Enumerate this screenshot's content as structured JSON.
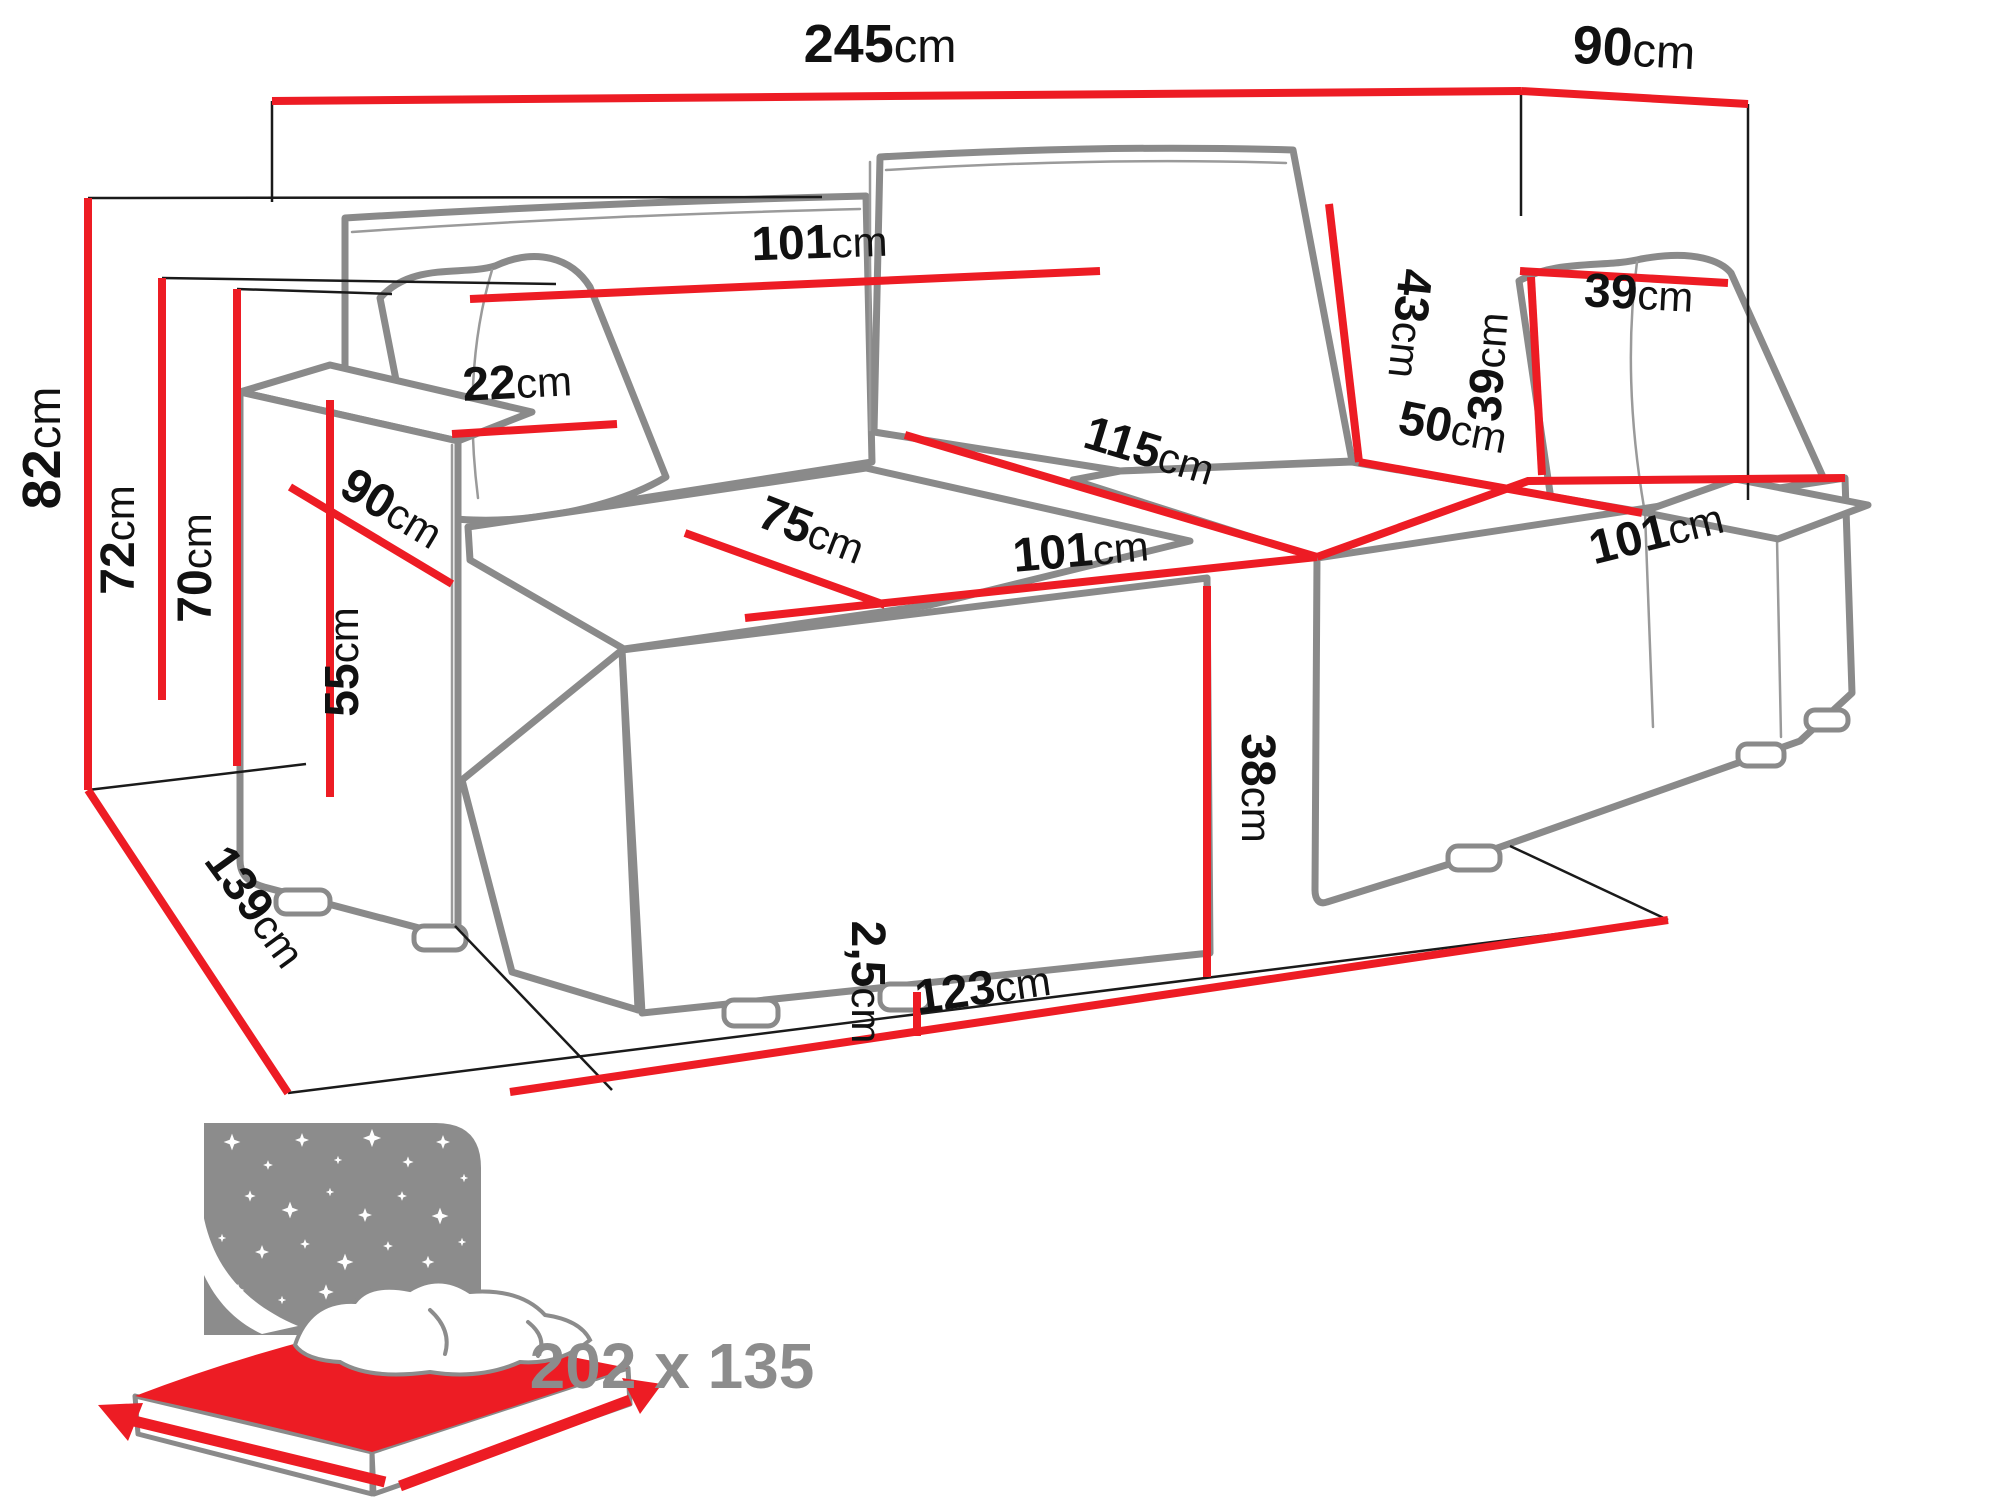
{
  "diagram": {
    "dimensions": {
      "overall_width": {
        "value": "245",
        "unit": "cm"
      },
      "overall_depth_right": {
        "value": "90",
        "unit": "cm"
      },
      "total_height": {
        "value": "82",
        "unit": "cm"
      },
      "backrest_height": {
        "value": "72",
        "unit": "cm"
      },
      "backrest_height_inner": {
        "value": "70",
        "unit": "cm"
      },
      "backrest_width": {
        "value": "101",
        "unit": "cm"
      },
      "back_cushion_height": {
        "value": "43",
        "unit": "cm"
      },
      "pillow_width": {
        "value": "39",
        "unit": "cm"
      },
      "pillow_height": {
        "value": "39",
        "unit": "cm"
      },
      "armrest_width": {
        "value": "22",
        "unit": "cm"
      },
      "armrest_depth": {
        "value": "90",
        "unit": "cm"
      },
      "armrest_height": {
        "value": "55",
        "unit": "cm"
      },
      "seat_depth_corner": {
        "value": "50",
        "unit": "cm"
      },
      "corner_diagonal": {
        "value": "115",
        "unit": "cm"
      },
      "seat_depth_front": {
        "value": "75",
        "unit": "cm"
      },
      "seat_width": {
        "value": "101",
        "unit": "cm"
      },
      "chaise_width": {
        "value": "101",
        "unit": "cm"
      },
      "seat_front_height": {
        "value": "38",
        "unit": "cm"
      },
      "leg_clearance": {
        "value": "2,5",
        "unit": "cm"
      },
      "front_width": {
        "value": "123",
        "unit": "cm"
      },
      "side_depth": {
        "value": "139",
        "unit": "cm"
      }
    },
    "sleeping_area": {
      "size": "202 x 135"
    },
    "colors": {
      "dimension_line": "#ed1c24",
      "sofa_outline": "#8a8a8a",
      "label_text": "#111111",
      "icon_gray": "#8c8c8c"
    }
  }
}
